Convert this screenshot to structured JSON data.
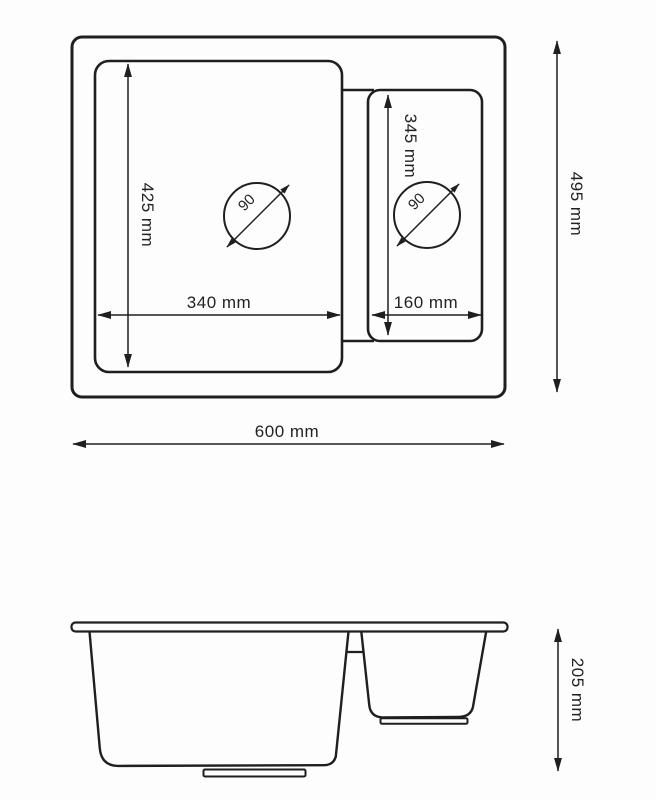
{
  "title": "Kitchen sink technical dimension drawing, one-and-a-half bowl",
  "colors": {
    "background": "#fdfdfd",
    "line": "#1f1f1f",
    "text": "#222222"
  },
  "top_view": {
    "labels": {
      "overall_width": "600 mm",
      "overall_depth": "495 mm",
      "main_bowl_width": "340 mm",
      "main_bowl_depth": "425 mm",
      "half_bowl_width": "160 mm",
      "half_bowl_depth": "345 mm",
      "main_drain_diameter": "90",
      "half_drain_diameter": "90"
    }
  },
  "front_view": {
    "labels": {
      "overall_height": "205 mm"
    }
  }
}
